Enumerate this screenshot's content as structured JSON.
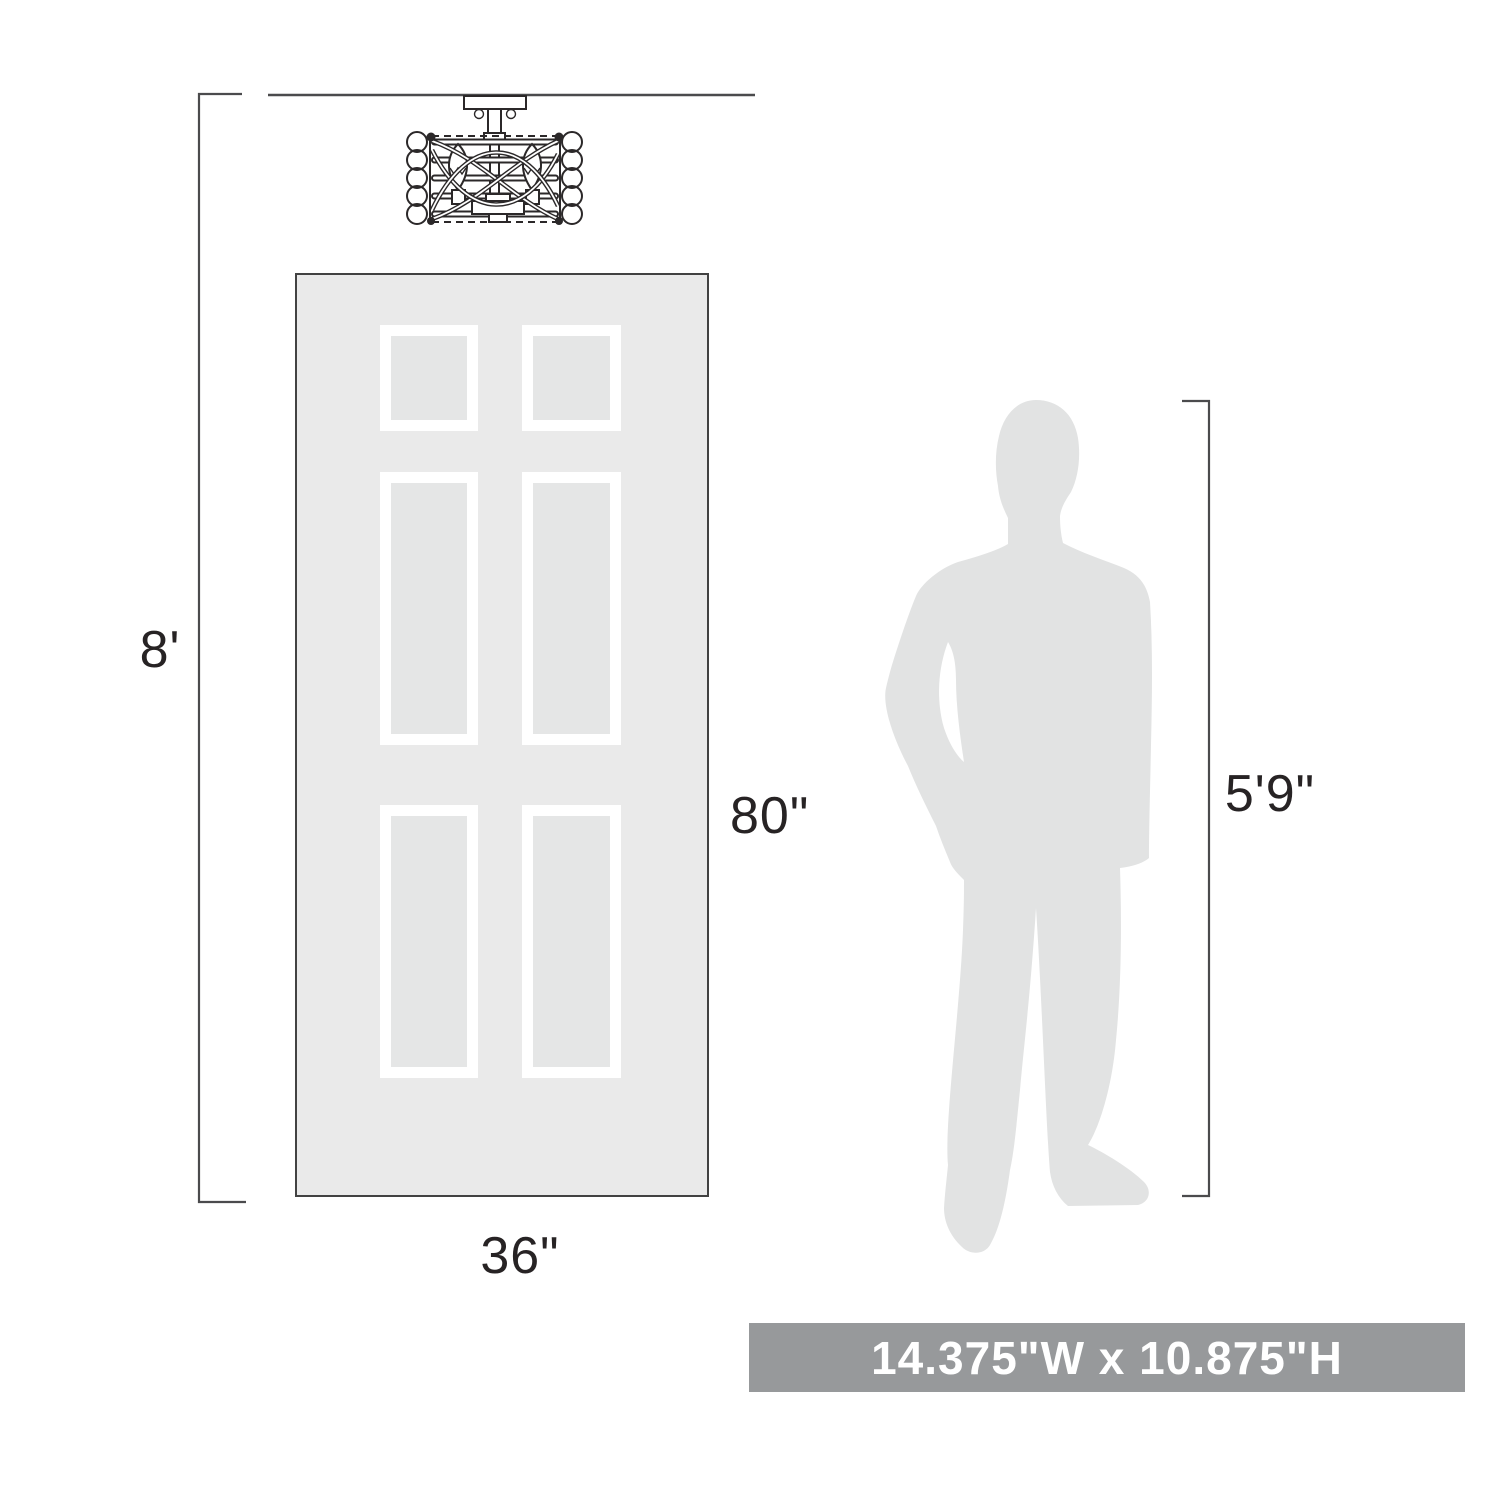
{
  "labels": {
    "ceiling_height": "8'",
    "door_height": "80\"",
    "door_width": "36\"",
    "person_height": "5'9\""
  },
  "banner": {
    "text": "14.375\"W x 10.875\"H"
  },
  "icons": {
    "fixture": "semi-flush-ceiling-light-line-drawing",
    "door": "six-panel-door-silhouette",
    "person": "standing-man-silhouette"
  },
  "colors": {
    "line": "#4b4b4d",
    "text": "#272324",
    "door_fill": "#eaeaea",
    "door_border": "#424242",
    "panel_frame": "#ffffff",
    "panel_fill": "#e5e6e6",
    "person_fill": "#e2e3e3",
    "fixture_line": "#2b2829",
    "banner_bg": "#97999b",
    "banner_fg": "#ffffff"
  }
}
